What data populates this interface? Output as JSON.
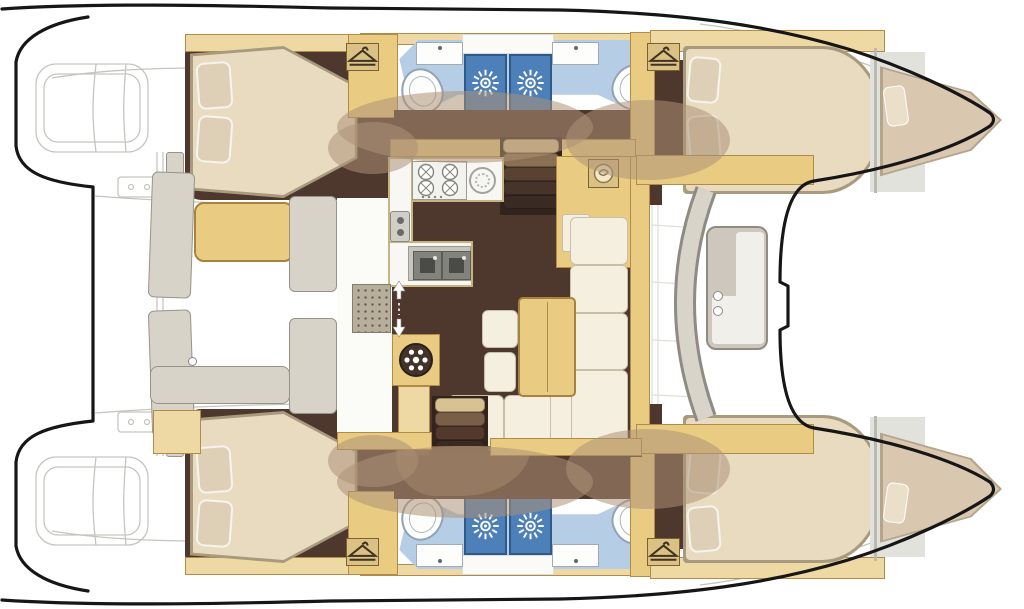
{
  "title": "Catamaran interior layout plan (top view)",
  "diagram_type": "yacht-floor-plan",
  "orientation": {
    "bow": "right",
    "stern": "left",
    "hulls": "top and bottom, mirrored"
  },
  "legend": {
    "double_cabins": 4,
    "bow_peak_berths": 2,
    "bathrooms": 4,
    "bathroom_fixtures_each": [
      "toilet",
      "washbasin",
      "shower-stall"
    ],
    "galley_fixtures": [
      "four-burner-stove",
      "round-hob",
      "oven",
      "double-sink"
    ],
    "salon_fixtures": [
      "l-shaped-sofa",
      "dining-table",
      "two-stools",
      "nav-cabinet"
    ],
    "companionway_stairs": 2,
    "aft_cockpit_fixtures": [
      "bench-seat",
      "side-panels",
      "table"
    ],
    "forward_cockpit_fixtures": [
      "curved-bench",
      "table-with-cupholders"
    ],
    "deck_features": [
      "dinghy-davits",
      "swim-platforms",
      "foredeck"
    ]
  },
  "icons": [
    {
      "name": "shower-head-icon",
      "meaning": "shower stall"
    },
    {
      "name": "clothes-hanger-icon",
      "meaning": "wardrobe"
    },
    {
      "name": "stove-burner-icon",
      "meaning": "galley cooktop"
    },
    {
      "name": "helm-wheel-icon",
      "meaning": "steering / wheel locker"
    },
    {
      "name": "up-down-arrows-icon",
      "meaning": "companionway direction"
    },
    {
      "name": "swirl-icon",
      "meaning": "basin / instrument"
    }
  ],
  "colors": {
    "outline": "#161616",
    "sketch": "#c5c5bf",
    "wood": "#e9cc82",
    "woodLight": "#eed9a4",
    "woodDark": "#b08c48",
    "floor": "#4e372c",
    "floorDark": "#32231c",
    "bath": "#b5cee6",
    "shower": "#4d7fb8",
    "showerEdge": "#2e5a8a",
    "mattress": "#e8dbc0",
    "mattressEdge": "#a79a7e",
    "pillow": "#ddd0b6",
    "cushion": "#f5efdf",
    "cushionEdge": "#c6bfa9",
    "greige": "#d8d3c9",
    "greigeEdge": "#97938a",
    "landing": "#7d6049",
    "blob": "rgba(173,145,118,0.55)"
  }
}
